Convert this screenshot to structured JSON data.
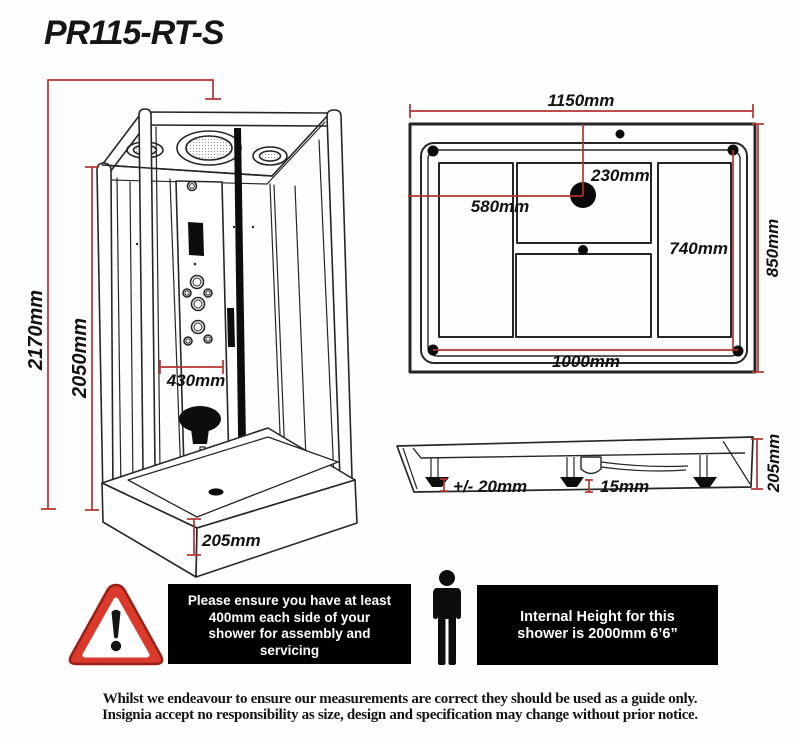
{
  "title": "PR115-RT-S",
  "front_view": {
    "height_total": "2170mm",
    "height_glass": "2050mm",
    "panel_width": "430mm",
    "tray_height": "205mm"
  },
  "plan_view": {
    "width_total": "1150mm",
    "depth_total": "850mm",
    "drain_offset_left": "580mm",
    "drain_offset_top": "230mm",
    "base_width": "1000mm",
    "base_depth": "740mm"
  },
  "side_view": {
    "feet_adjustment": "+/- 20mm",
    "clearance": "15mm",
    "tray_height": "205mm"
  },
  "notices": {
    "assembly_lines": [
      "Please ensure you have at least",
      "400mm each side of your",
      "shower for assembly and",
      "servicing"
    ],
    "internal_height_lines": [
      "Internal Height for this",
      "shower is 2000mm 6’6”"
    ]
  },
  "disclaimer": {
    "line1": "Whilst we endeavour to ensure our measurements are correct they should be used as a guide only.",
    "line2": "Insignia accept no responsibility as size, design and specification may change without prior notice."
  },
  "icons": {
    "warning": "warning-triangle-icon",
    "person": "person-height-icon"
  },
  "colors": {
    "dimension_red": "#b2342e",
    "ink": "#262626",
    "notice_bg": "#000000",
    "notice_text": "#ffffff",
    "warning_red": "#d93a2b"
  }
}
